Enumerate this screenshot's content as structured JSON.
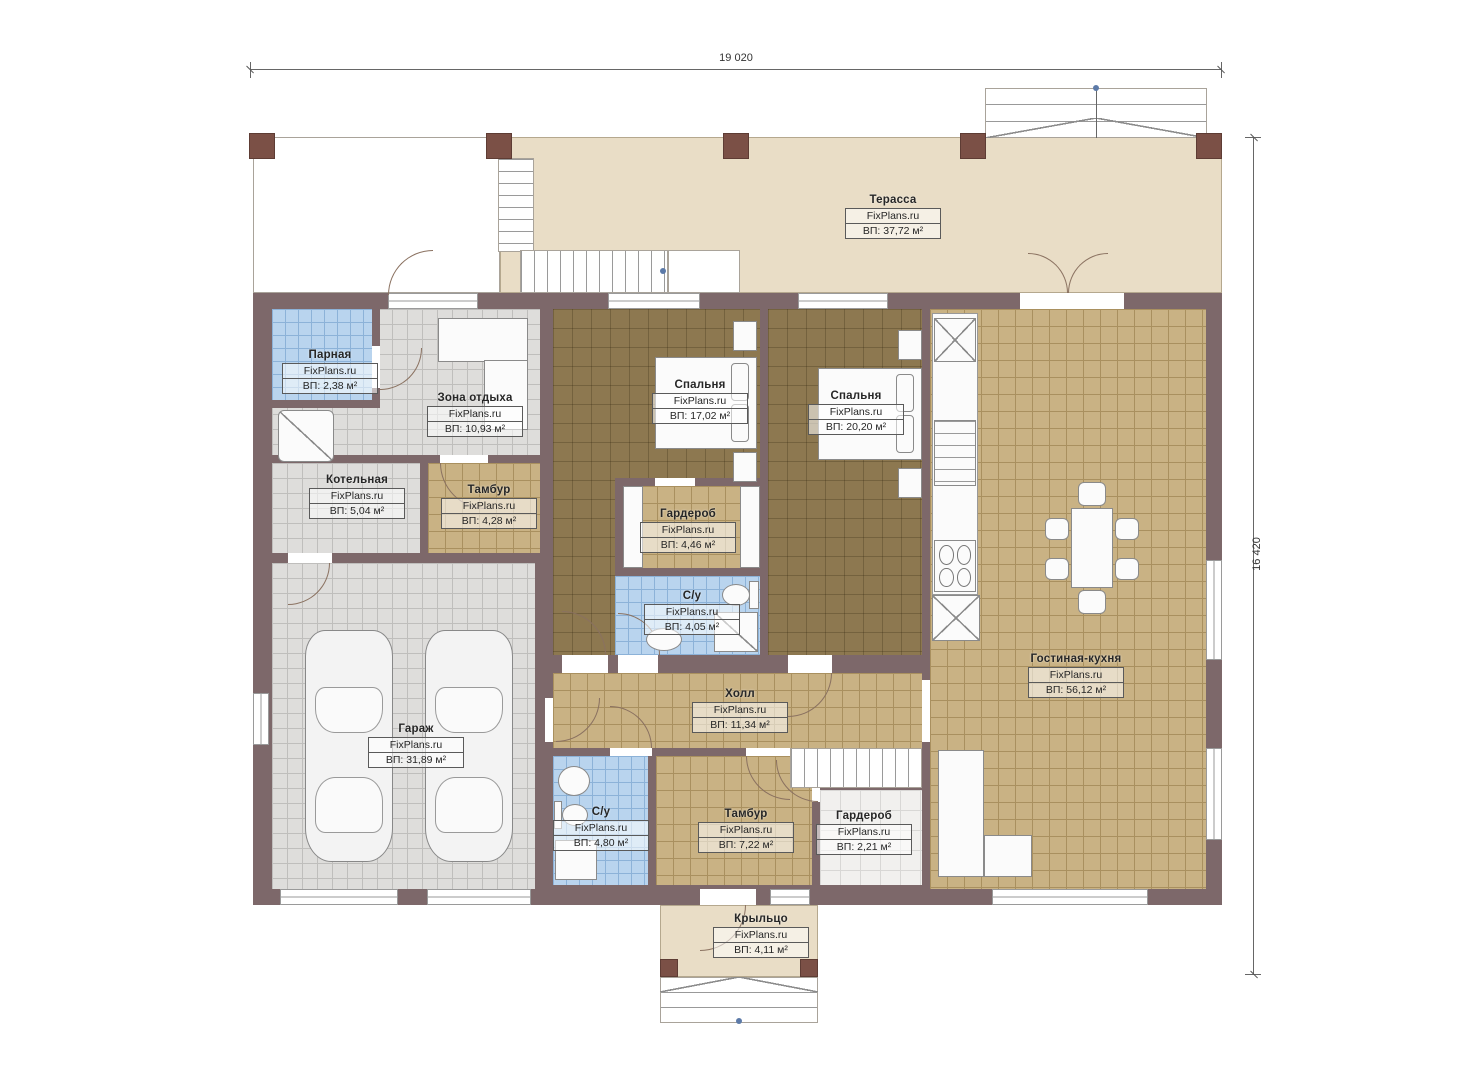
{
  "watermark": "FixPlans.ru",
  "dimensions": {
    "width": "19 020",
    "height": "16 420"
  },
  "colors": {
    "wall": "#7d686a",
    "column": "#7b5046",
    "terrace_floor": "#e9ddc6",
    "tile_tan": "#c9b284",
    "tile_gray": "#dedddb",
    "tile_blue": "#b9d4ee",
    "wood_floor": "#8d7850",
    "dimension_line": "#666666"
  },
  "rooms": {
    "terrace": {
      "name": "Терасса",
      "area": "ВП: 37,72 м²"
    },
    "parnaya": {
      "name": "Парная",
      "area": "ВП: 2,38 м²"
    },
    "zona": {
      "name": "Зона отдыха",
      "area": "ВП: 10,93 м²"
    },
    "kotelnaya": {
      "name": "Котельная",
      "area": "ВП: 5,04 м²"
    },
    "tambur1": {
      "name": "Тамбур",
      "area": "ВП: 4,28 м²"
    },
    "bedroom1": {
      "name": "Спальня",
      "area": "ВП: 17,02 м²"
    },
    "bedroom2": {
      "name": "Спальня",
      "area": "ВП: 20,20 м²"
    },
    "wardrobe1": {
      "name": "Гардероб",
      "area": "ВП: 4,46 м²"
    },
    "su1": {
      "name": "С/у",
      "area": "ВП: 4,05 м²"
    },
    "garage": {
      "name": "Гараж",
      "area": "ВП: 31,89 м²"
    },
    "hall": {
      "name": "Холл",
      "area": "ВП: 11,34 м²"
    },
    "su2": {
      "name": "С/у",
      "area": "ВП: 4,80 м²"
    },
    "tambur2": {
      "name": "Тамбур",
      "area": "ВП: 7,22 м²"
    },
    "wardrobe2": {
      "name": "Гардероб",
      "area": "ВП: 2,21 м²"
    },
    "living": {
      "name": "Гостиная-кухня",
      "area": "ВП: 56,12 м²"
    },
    "porch": {
      "name": "Крыльцо",
      "area": "ВП: 4,11 м²"
    }
  }
}
